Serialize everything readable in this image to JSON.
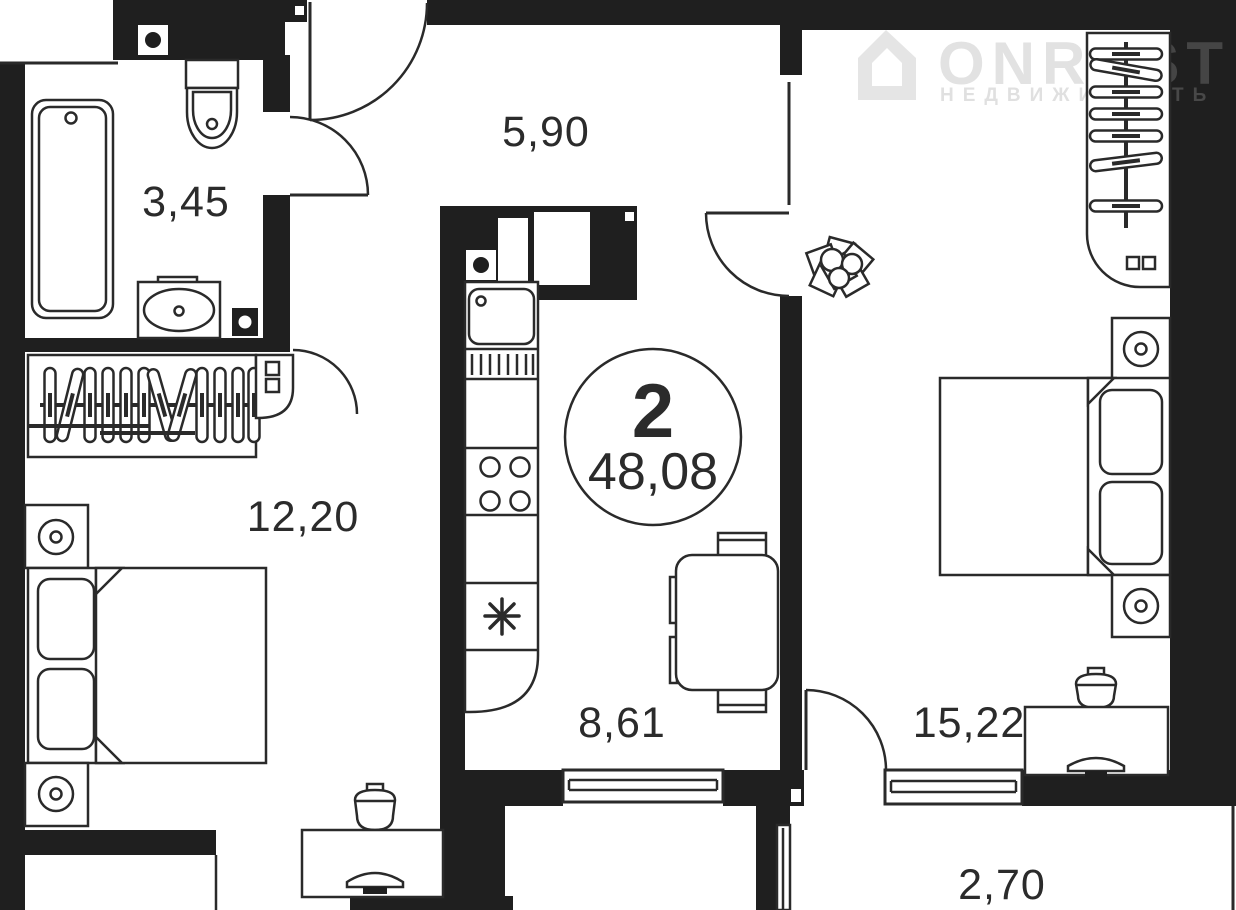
{
  "badge": {
    "rooms_count": "2",
    "total_area": "48,08"
  },
  "rooms": {
    "bathroom": "3,45",
    "hallway": "5,90",
    "bedroom_left": "12,20",
    "kitchen_dining": "8,61",
    "bedroom_right": "15,22",
    "balcony": "2,70"
  },
  "watermark": {
    "brand": "ONREST",
    "tagline": "НЕДВИЖИМОСТЬ"
  },
  "colors": {
    "wall": "#1f1f1f",
    "line": "#2a2a2a",
    "background": "#ffffff",
    "watermark": "rgba(160,160,160,0.30)"
  }
}
